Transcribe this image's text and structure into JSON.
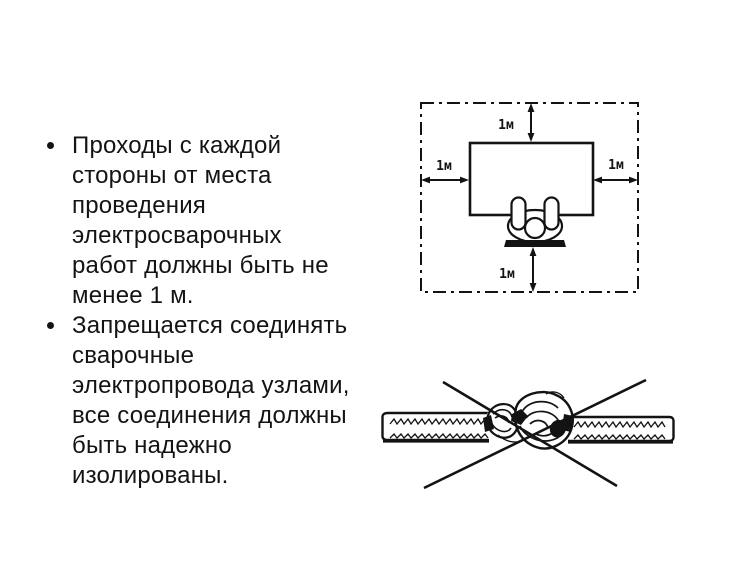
{
  "slide": {
    "background_color": "#ffffff",
    "ink_color": "#131313"
  },
  "content": {
    "bullets": [
      {
        "lines": [
          "Проходы с каждой",
          "стороны от места",
          "проведения",
          "электросварочных",
          "работ должны быть не",
          "менее 1 м."
        ]
      },
      {
        "lines": [
          "Запрещается соединять",
          "сварочные",
          "электропровода узлами,",
          "все соединения должны",
          "быть надежно",
          "изолированы."
        ]
      }
    ]
  },
  "clearance_diagram": {
    "description": "welding workplace with 1 m clearance on all sides",
    "labels": {
      "top": "1м",
      "left": "1м",
      "right": "1м",
      "bottom": "1м"
    }
  },
  "knot_diagram": {
    "description": "welding cables tied in a knot, crossed out as prohibited"
  }
}
